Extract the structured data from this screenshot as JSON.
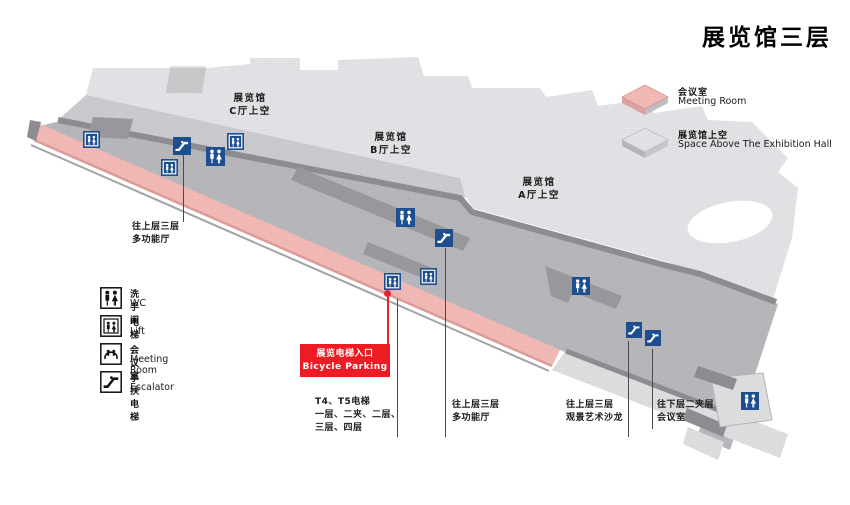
{
  "title": "展览馆三层",
  "legend_right": {
    "items": [
      {
        "zh": "会议室",
        "en": "Meeting Room"
      },
      {
        "zh": "展览馆上空",
        "en": "Space Above The Exhibition Hall"
      }
    ]
  },
  "legend_left": {
    "items": [
      {
        "zh": "洗手间",
        "en": "WC"
      },
      {
        "zh": "电梯",
        "en": "Lift"
      },
      {
        "zh": "会议室",
        "en": "Meeting Room"
      },
      {
        "zh": "手扶电梯",
        "en": "Escalator"
      }
    ]
  },
  "map": {
    "halls": [
      {
        "l1": "展览馆",
        "l2": "C厅上空"
      },
      {
        "l1": "展览馆",
        "l2": "B厅上空"
      },
      {
        "l1": "展览馆",
        "l2": "A厅上空"
      }
    ],
    "notes": {
      "upper_left": {
        "l1": "往上层三层",
        "l2": "多功能厅"
      },
      "elevator_entrance": {
        "l1": "展览电梯入口",
        "l2": "Bicycle Parking"
      },
      "t4t5": {
        "l1": "T4、T5电梯",
        "l2": "一层、二夹、二层、",
        "l3": "三层、四层"
      },
      "multi_hall": {
        "l1": "往上层三层",
        "l2": "多功能厅"
      },
      "art_salon": {
        "l1": "往上层三层",
        "l2": "观景艺术沙龙"
      },
      "mezzanine_meeting": {
        "l1": "往下层二夹层",
        "l2": "会议室"
      }
    },
    "markers": [
      {
        "type": "lift"
      },
      {
        "type": "escalator"
      },
      {
        "type": "lift"
      },
      {
        "type": "wc"
      },
      {
        "type": "lift"
      },
      {
        "type": "wc"
      },
      {
        "type": "escalator"
      },
      {
        "type": "lift"
      },
      {
        "type": "lift"
      },
      {
        "type": "wc"
      },
      {
        "type": "escalator"
      },
      {
        "type": "escalator"
      },
      {
        "type": "wc"
      }
    ]
  },
  "colors": {
    "marker_blue": "#1d4e8e",
    "accent_red": "#e8232b",
    "meeting_pink": "#f0b6b2",
    "hall_gray": "#e2e2e5"
  }
}
